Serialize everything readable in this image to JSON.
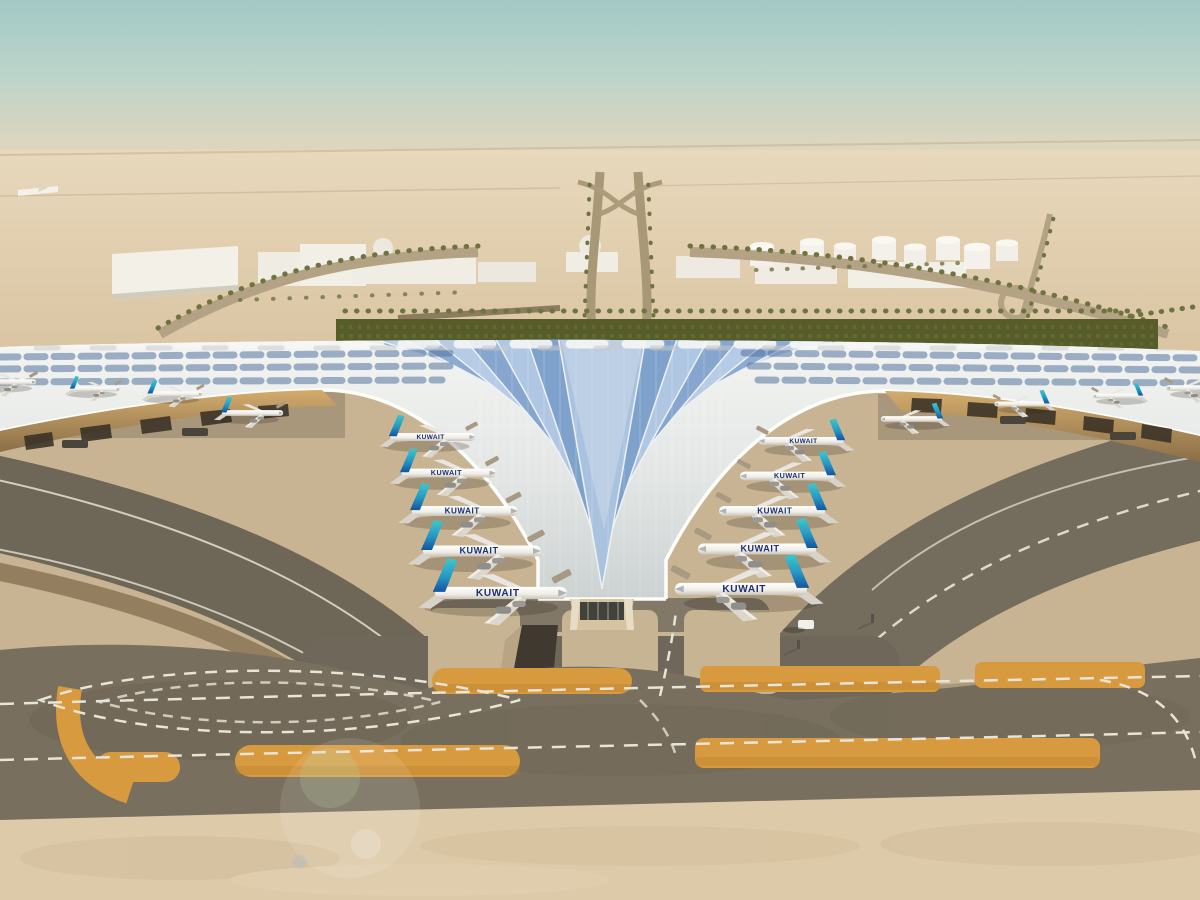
{
  "scene": {
    "airline_title": "KUWAIT",
    "aircraft_counts": {
      "left_gates": 5,
      "right_gates": 5,
      "left_wing_stands": 4,
      "right_wing_stands": 4
    },
    "palette": {
      "sky_top": "#a2c9c6",
      "horizon_haze": "#e2d5ba",
      "desert_sand": "#e5d3b4",
      "roof_white": "#eef0ee",
      "skylight_blue": "#8fadd3",
      "tail_teal": "#3fc8cc",
      "tail_navy": "#14549f",
      "title_navy": "#1c2f73",
      "apron_concrete": "#c8b493",
      "asphalt": "#786f5e",
      "sand_strip_orange": "#d89a3e",
      "greenery_olive": "#565c2a",
      "soffit_gold": "#c9a25e",
      "bottom_sand": "#ddcaa9"
    }
  }
}
